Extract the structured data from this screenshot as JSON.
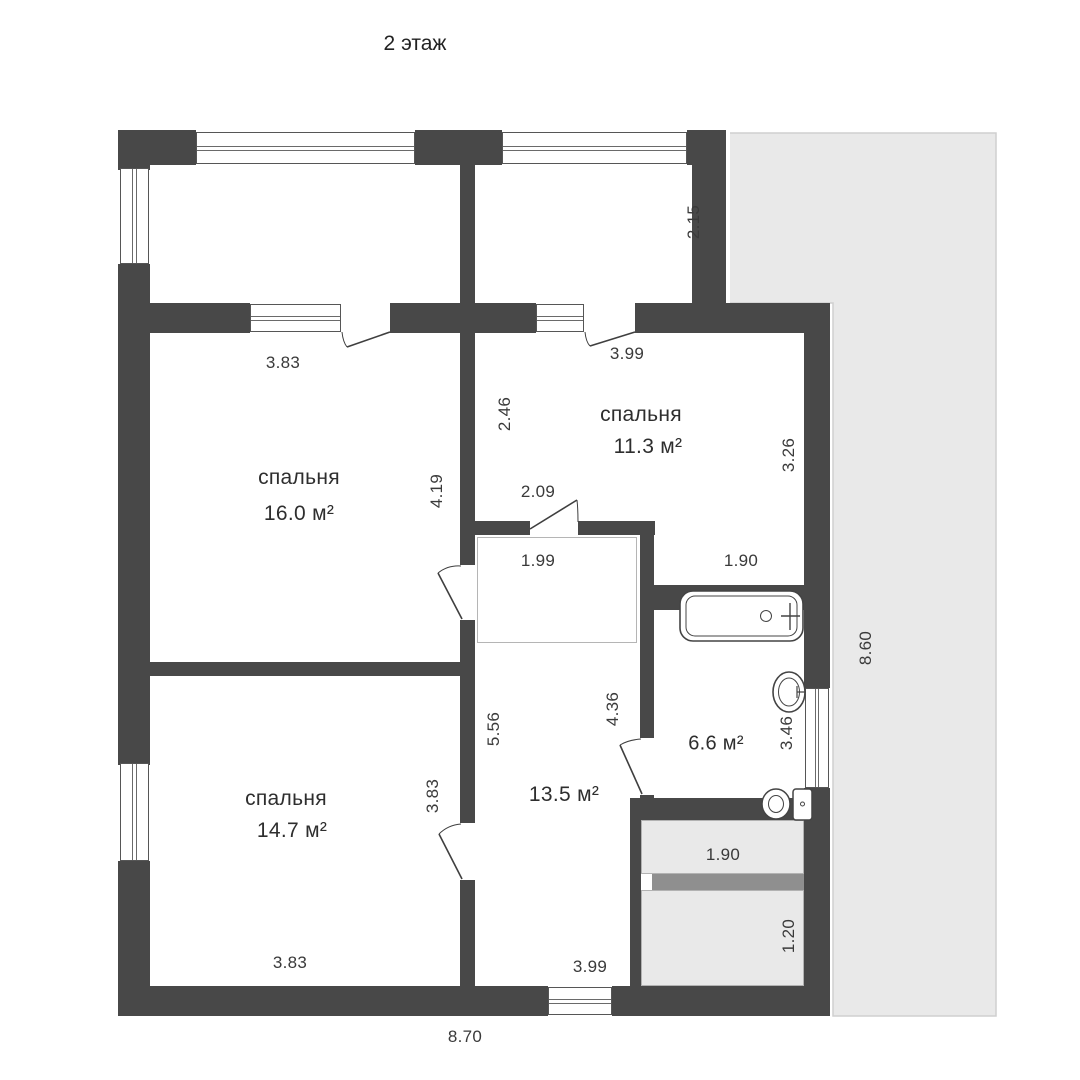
{
  "floor_title": "2 этаж",
  "rooms": {
    "bedroom_top": {
      "name": "спальня",
      "area": "16.0 м²"
    },
    "bedroom_right": {
      "name": "спальня",
      "area": "11.3 м²"
    },
    "bedroom_bottom": {
      "name": "спальня",
      "area": "14.7 м²"
    },
    "hall": {
      "area": "13.5 м²"
    },
    "bathroom": {
      "area": "6.6 м²"
    }
  },
  "dimensions": {
    "top_left_width": "3.83",
    "top_right_width": "3.99",
    "balcony_right_depth": "2.15",
    "hall_upper_height": "2.46",
    "bedroom_top_height": "4.19",
    "hall_door_width": "2.09",
    "stair_landing_width": "1.99",
    "bedroom_right_bottom_width": "1.90",
    "bedroom_right_height": "3.26",
    "hall_left_height": "5.56",
    "bathroom_wall_height": "4.36",
    "bathroom_right_height": "3.46",
    "bedroom_bottom_height": "3.83",
    "stair_upper_width": "1.90",
    "stair_lower_height": "1.20",
    "bedroom_bottom_width": "3.83",
    "hall_bottom_width": "3.99",
    "building_width": "8.70",
    "terrace_height": "8.60"
  }
}
